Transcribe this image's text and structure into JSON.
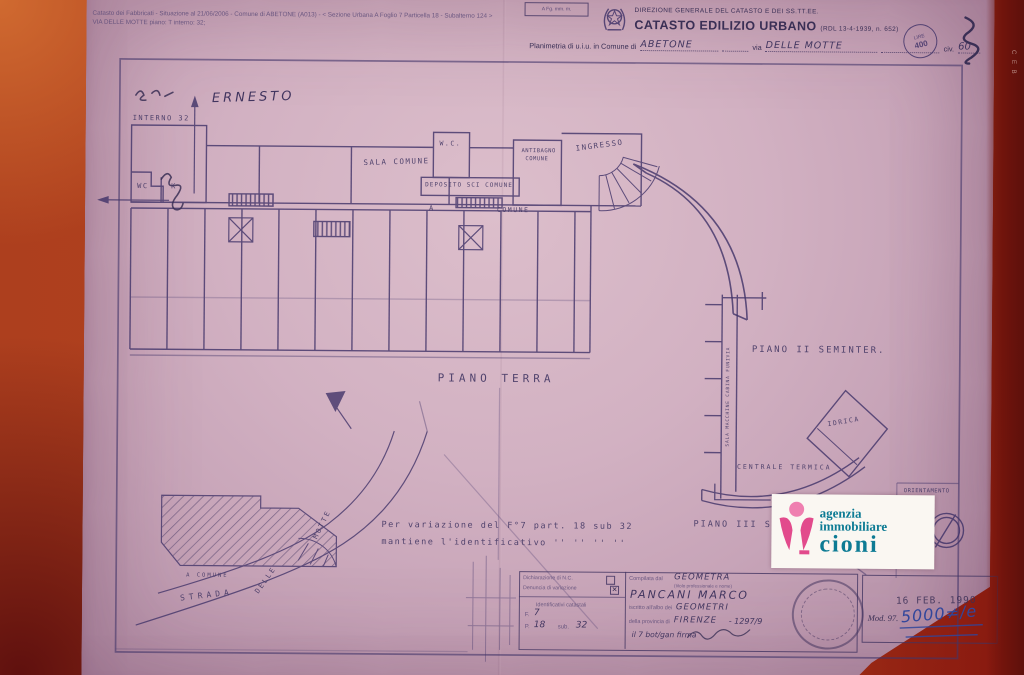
{
  "colors": {
    "background": "#b5431d",
    "paper": "#cdabbe",
    "ink": "#43356a",
    "pink": "#e24a8c",
    "teal": "#0d7b94",
    "blue_ink": "#31469b"
  },
  "top_note": {
    "line1": "Catasto dei Fabbricati - Situazione al 21/06/2006 - Comune di ABETONE (A013) - < Sezione Urbana A Foglio 7 Particella 18 - Subalterno 124 >",
    "line2": "VIA DELLE MOTTE piano: T interno: 32;"
  },
  "header": {
    "corner_box": "A Fg. mm. m.",
    "department": "DIREZIONE GENERALE DEL CATASTO E DEI SS.TT.EE.",
    "title": "CATASTO EDILIZIO URBANO",
    "title_ref": "(RDL 13-4-1939, n. 652)",
    "planimetria_prefix": "Planimetria di u.i.u. in Comune di",
    "comune_value": "ABETONE",
    "via_label": "via",
    "via_value": "DELLE  MOTTE",
    "civ_label": "civ.",
    "civ_value": "60"
  },
  "revenue_stamp": {
    "top": "LIRE",
    "bottom": "400"
  },
  "plan": {
    "piano_terra": "PIANO  TERRA",
    "interno": "INTERNO 32",
    "ernesto": "ERNESTO",
    "wc": "WC",
    "k": "K",
    "sala_comune": "SALA  COMUNE",
    "wc_top": "W.C.",
    "antibagno_1": "ANTIBAGNO",
    "antibagno_2": "COMUNE",
    "ingresso": "INGRESSO",
    "deposito": "DEPOSITO  SCI  COMUNE",
    "comune": "COMUNE",
    "a": "A",
    "piano2": "PIANO II SEMINTER.",
    "funivia": "SALA MACCHINE CABINA FUNIVIA",
    "idrica": "IDRICA",
    "centrale": "CENTRALE  TERMICA",
    "piano3": "PIANO III S",
    "orientamento": "ORIENTAMENTO"
  },
  "site": {
    "strada": "STRADA",
    "delle": "DELLE",
    "motte": "MOTTE",
    "a_comune": "A  COMUNE"
  },
  "variation": {
    "line1": "Per  variazione  del  F°7  part. 18  sub  32",
    "line2": "mantiene  l'identificativo    ''    ''    ''    ''"
  },
  "table": {
    "dichiarazione": "Dichiarazione di N.C.",
    "denuncia": "Denuncia di variazione",
    "denuncia_mark": "✕",
    "identificativi": "Identificativi catastali",
    "f_label": "F.",
    "f_value": "7",
    "p_label": "P.",
    "p_value": "18",
    "sub_label": "sub.",
    "sub_value": "32",
    "compilata": "Compilata dal",
    "compilata_value": "GEOMETRA",
    "titolo_note": "(titolo professionale e nome)",
    "nome": "PANCANI  MARCO",
    "iscritto": "iscritto all'albo dei",
    "albo_value": "GEOMETRI",
    "provincia": "della provincia di",
    "provincia_value": "FIRENZE",
    "numero": "- 1297/9",
    "firma_line": "il 7 bot/gan   firma"
  },
  "date_box": {
    "stamp_row1": "▚▘▞▚▘▞▘▚▞▘▚▞",
    "stamp_row2": "▞▚▘▞▘▚▞▘▞▚▘",
    "date": "16 FEB. 1990",
    "mod_label": "Mod. 97.",
    "mod_value": "5000≠/e"
  },
  "edge": {
    "text": "C E B"
  },
  "watermark": {
    "line1": "agenzia",
    "line2": "immobiliare",
    "line3": "cioni"
  }
}
